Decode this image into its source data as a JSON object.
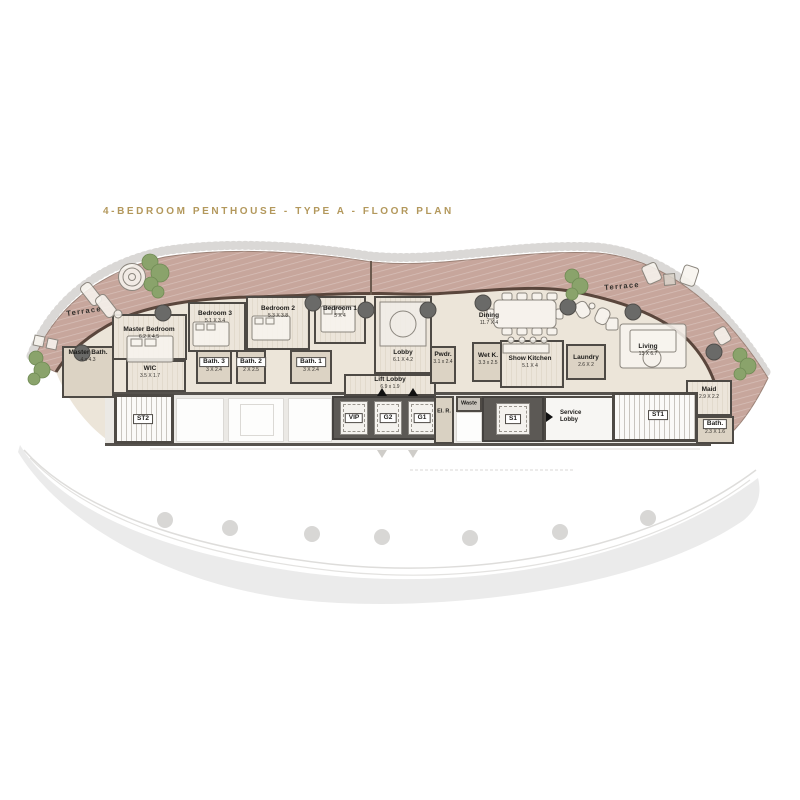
{
  "title": "4-BEDROOM PENTHOUSE - TYPE A - FLOOR PLAN",
  "terraces": {
    "left": "Terrace",
    "right": "Terrace"
  },
  "rooms": {
    "master_bath": {
      "name": "Master Bath.",
      "dims": "4 x 4.3"
    },
    "master_bedroom": {
      "name": "Master Bedroom",
      "dims": "6.2 X 4.5"
    },
    "wic": {
      "name": "WIC",
      "dims": "3.5 X 1.7"
    },
    "bedroom3": {
      "name": "Bedroom 3",
      "dims": "5.1 X 3.4"
    },
    "bath3": {
      "name": "Bath. 3",
      "dims": "3 X 2.4"
    },
    "bath2": {
      "name": "Bath. 2",
      "dims": "2 X 2.5"
    },
    "bedroom2": {
      "name": "Bedroom 2",
      "dims": "5.3 X 3.8"
    },
    "bath1": {
      "name": "Bath. 1",
      "dims": "3 X 2.4"
    },
    "bedroom1": {
      "name": "Bedroom 1",
      "dims": "5 X 4"
    },
    "lobby": {
      "name": "Lobby",
      "dims": "6.1 X 4.2"
    },
    "lift_lobby": {
      "name": "Lift Lobby",
      "dims": "6.9 x 1.9"
    },
    "pwdr": {
      "name": "Pwdr.",
      "dims": "3.1 x 2.4"
    },
    "wet_kitchen": {
      "name": "Wet K.",
      "dims": "3.3 x 2.5"
    },
    "show_kitchen": {
      "name": "Show Kitchen",
      "dims": "5.1 X 4"
    },
    "laundry": {
      "name": "Laundry",
      "dims": "2.6 X 2"
    },
    "dining": {
      "name": "Dining",
      "dims": "11.7 X 4"
    },
    "living": {
      "name": "Living",
      "dims": "13 X 6.7"
    },
    "maid": {
      "name": "Maid",
      "dims": "2.9 X 2.2"
    },
    "maid_bath": {
      "name": "Bath.",
      "dims": "2.3 X 1.6"
    },
    "st1": {
      "name": "ST1"
    },
    "st2": {
      "name": "ST2"
    },
    "lift_vip": {
      "name": "VIP"
    },
    "lift_g2": {
      "name": "G2"
    },
    "lift_g1": {
      "name": "G1"
    },
    "el_room": {
      "name": "El. R."
    },
    "waste": {
      "name": "Waste"
    },
    "lift_s1": {
      "name": "S1"
    },
    "service_lobby": {
      "name": "Service Lobby"
    }
  },
  "colors": {
    "title_gold": "#b3985c",
    "terrace": "#c7a69c",
    "exterior_wall": "#5a463c",
    "interior_wall": "#4e4a45",
    "wood_floor": "#e8e1d4",
    "tile_floor": "#dcd3c4",
    "ghost": "#ebebeb",
    "tree": "#8aa36b"
  }
}
